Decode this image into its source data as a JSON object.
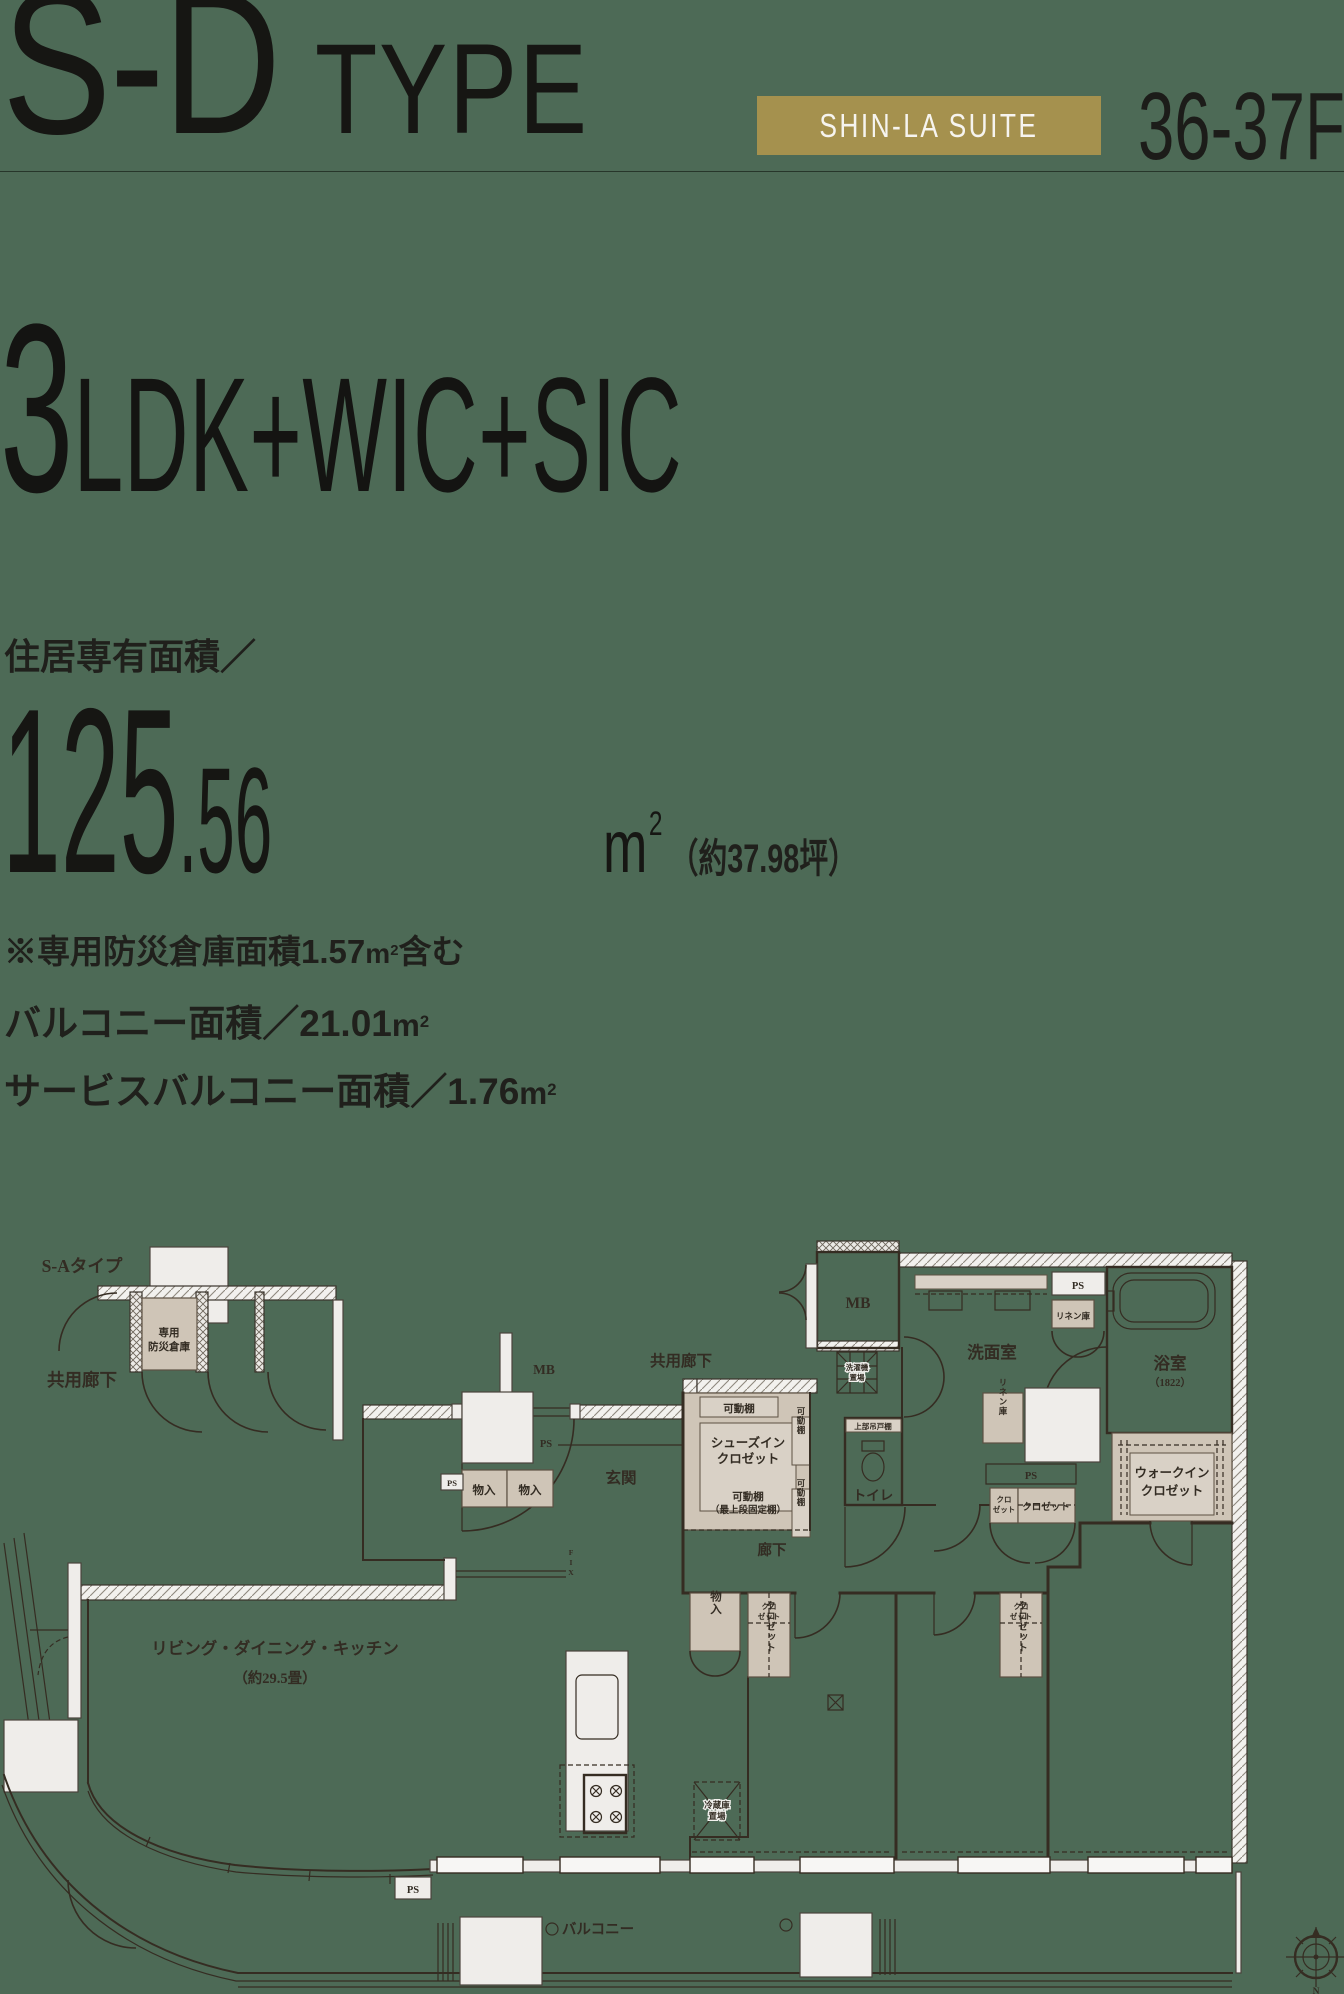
{
  "colors": {
    "background": "#4d6a56",
    "badge": "#a5914e",
    "ink": "#20201c",
    "closet_beige": "#cfc5b7"
  },
  "header": {
    "type_code": "S-D",
    "type_word": "TYPE",
    "badge_label": "SHIN-LA SUITE",
    "floors": "36-37F"
  },
  "layout": {
    "count": "3",
    "composition": "LDK+WIC+SIC"
  },
  "area": {
    "label": "住居専有面積／",
    "value_int": "125",
    "value_dec": ".56",
    "unit": "m",
    "unit_sup": "2",
    "tsubo": "（約37.98坪）",
    "note_pre": "※専用防災倉庫面積1.57",
    "note_suffix": "含む",
    "balcony_pre": "バルコニー面積／21.01",
    "service_pre": "サービスバルコニー面積／1.76"
  },
  "floorplan": {
    "labels": {
      "sa_type": "S-Aタイプ",
      "kyoyo_roka": "共用廊下",
      "bousai1": "専用",
      "bousai2": "防災倉庫",
      "mb": "MB",
      "ps": "PS",
      "monoire": "物入",
      "genkan": "玄関",
      "kadodana": "可動棚",
      "sic1": "シューズイン",
      "sic2": "クロゼット",
      "saijodan": "（最上段固定棚）",
      "sentakuki": "洗濯機",
      "okiba": "置場",
      "senmen": "洗面室",
      "linen": "リネン庫",
      "bath": "浴室",
      "bath_size": "（1822）",
      "joubu": "上部吊戸棚",
      "toilet": "トイレ",
      "wic1": "ウォークイン",
      "wic2": "クロゼット",
      "kuro": "クロ",
      "zetto": "ゼット",
      "closet": "クロゼット",
      "rouka": "廊下",
      "fix": "FIX",
      "reizoko": "冷蔵庫",
      "ldk1": "リビング・ダイニング・キッチン",
      "ldk2": "（約29.5畳）",
      "room2a": "洋室(2)",
      "room2b": "（約5.5畳）",
      "room3a": "洋室(3)",
      "room3b": "（約5.4畳）",
      "room1a": "洋室(1)",
      "room1b": "（約10.0畳）",
      "balcony": "バルコニー",
      "north": "N"
    }
  }
}
